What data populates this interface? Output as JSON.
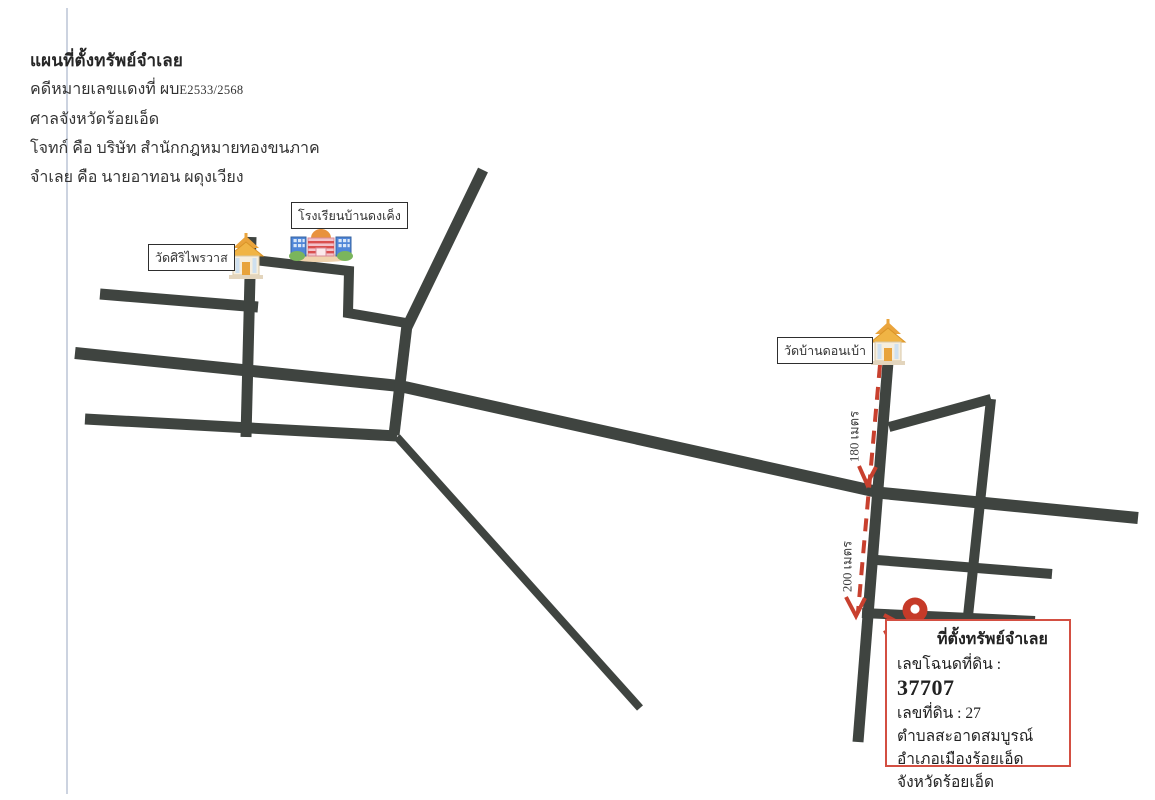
{
  "document": {
    "title": "แผนที่ตั้งทรัพย์จำเลย",
    "case_prefix": "คดีหมายเลขแดงที่ ผบ",
    "case_number": "E2533/2568",
    "court_line": "ศาลจังหวัดร้อยเอ็ด",
    "plaintiff_line": "โจทก์ คือ บริษัท สำนักกฎหมายทองขนภาค",
    "defendant_line": "จำเลย คือ นายอาทอน ผดุงเวียง"
  },
  "map": {
    "labels": {
      "temple_left": "วัดศิริไพรวาส",
      "school": "โรงเรียนบ้านดงเค็ง",
      "temple_right": "วัดบ้านดอนเบ้า"
    },
    "distances": {
      "segment_1": "180 เมตร",
      "segment_2": "200 เมตร"
    },
    "icons": {
      "temple_left": "thai-temple",
      "temple_right": "thai-temple",
      "school": "school-building",
      "property_pin": "location-pin"
    },
    "colors": {
      "road": "#3f4440",
      "route_dashed": "#c8402e",
      "info_box_border": "#d34f42",
      "pin_red": "#c63a28",
      "pin_blue": "#2e7fd6",
      "temple_gold": "#eaa43c"
    }
  },
  "info_box": {
    "title": "ที่ตั้งทรัพย์จำเลย",
    "deed_label": "เลขโฉนดที่ดิน :",
    "deed_number": "37707",
    "parcel_label": "เลขที่ดิน :",
    "parcel_number": "27",
    "subdistrict": "ตำบลสะอาดสมบูรณ์",
    "district": "อำเภอเมืองร้อยเอ็ด",
    "province": "จังหวัดร้อยเอ็ด"
  }
}
